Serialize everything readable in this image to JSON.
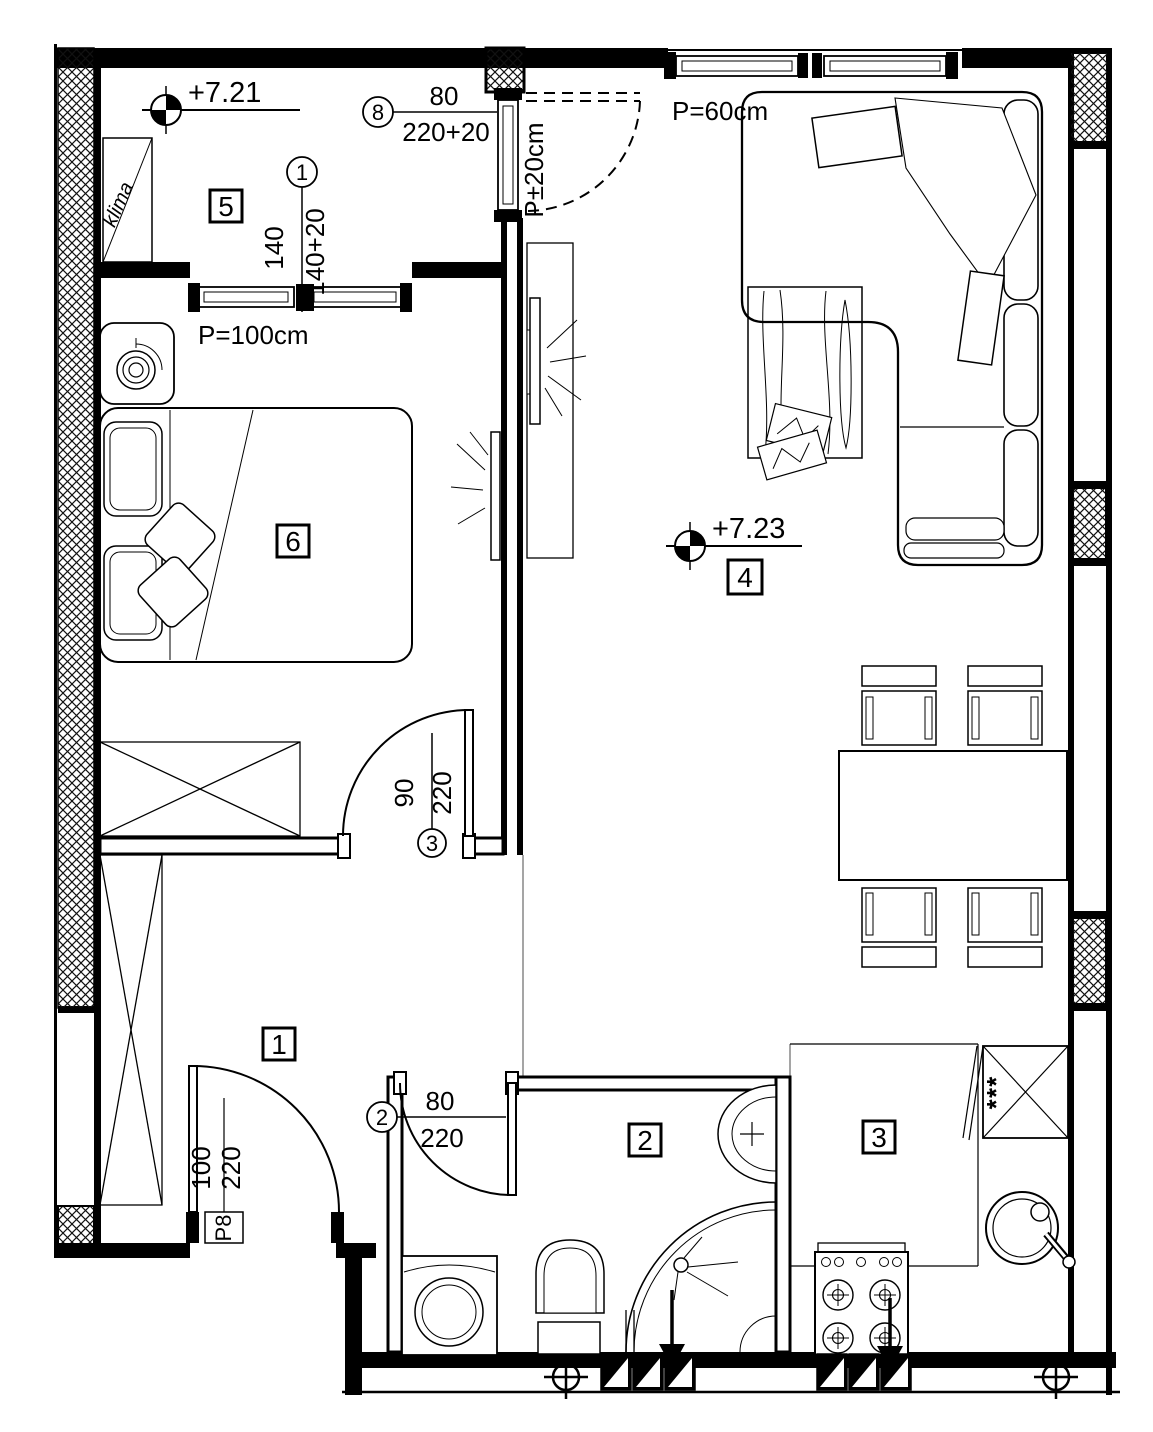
{
  "plan": {
    "rooms": [
      {
        "number": "1"
      },
      {
        "number": "2"
      },
      {
        "number": "3"
      },
      {
        "number": "4"
      },
      {
        "number": "5"
      },
      {
        "number": "6"
      }
    ],
    "level_markers": [
      {
        "value": "+7.21"
      },
      {
        "value": "+7.23"
      }
    ],
    "openings": [
      {
        "ref": "1",
        "width": "140",
        "height": "140+20"
      },
      {
        "ref": "2",
        "width": "80",
        "height": "220"
      },
      {
        "ref": "3",
        "width": "90",
        "height": "220"
      },
      {
        "ref": "8",
        "width": "80",
        "height": "220+20"
      }
    ],
    "entrance_door": {
      "label": "P8",
      "width": "100",
      "height": "220"
    },
    "parapets": {
      "living_room_window": "P=60cm",
      "loggia_window": "P=100cm",
      "loggia_door": "P±20cm"
    },
    "ac_unit_label": "klima",
    "fridge_freezer_mark": "***",
    "colors": {
      "line": "#000000",
      "background": "#ffffff"
    }
  }
}
